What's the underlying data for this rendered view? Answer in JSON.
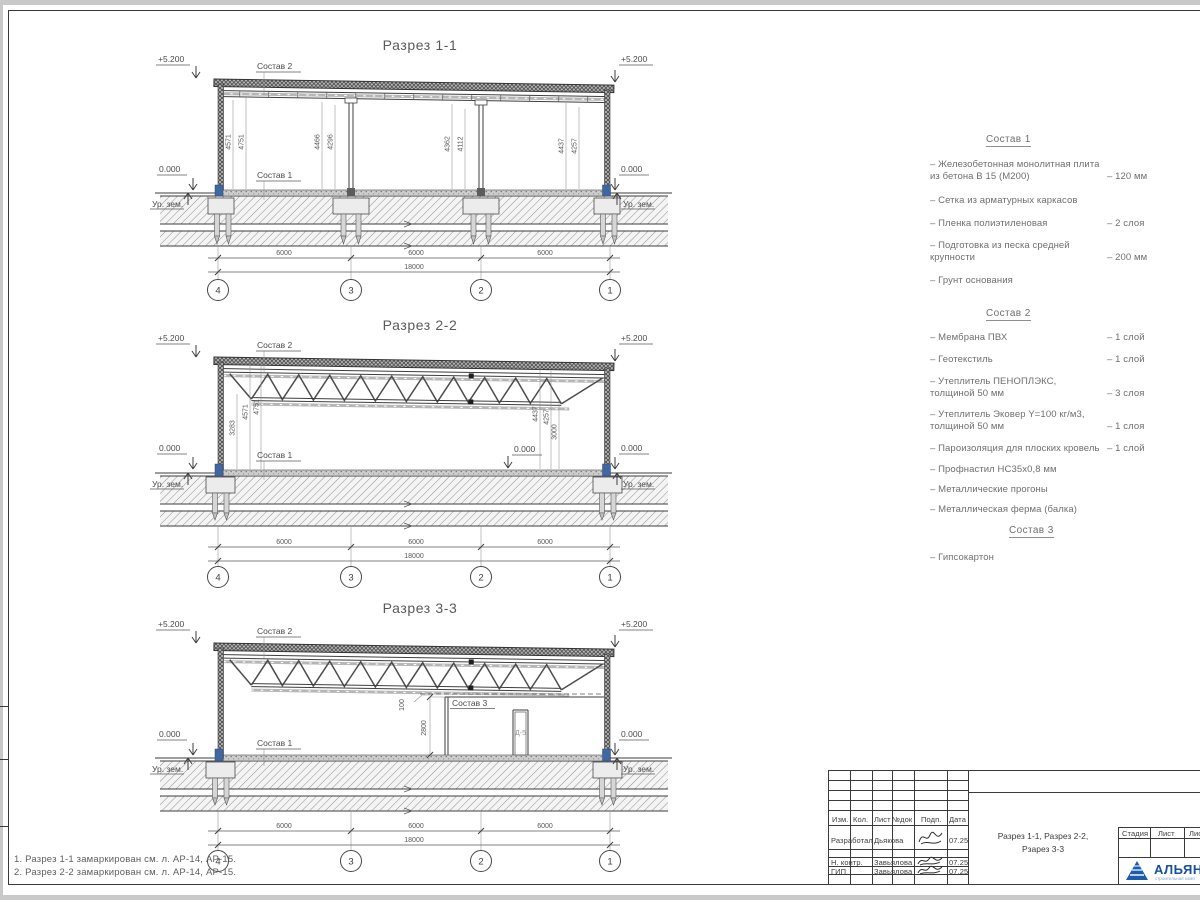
{
  "colors": {
    "logo_blue": "#17509e",
    "logo_sub_blue": "#7aa7d4",
    "line_dark": "#3a3a3a",
    "text_gray": "#6f6f6f",
    "column_base_blue": "#41679e"
  },
  "sections": {
    "s1": {
      "title": "Разрез 1-1",
      "elev": "+5.200",
      "zero": "0.000",
      "ground": "Ур. зем.",
      "c1": "Состав 1",
      "c2": "Состав 2",
      "v1": "4571",
      "v2": "4751",
      "v3": "4466",
      "v4": "4296",
      "v5": "4362",
      "v6": "4112",
      "v7": "4437",
      "v8": "4257",
      "d1": "6000",
      "d2": "6000",
      "d3": "6000",
      "dt": "18000",
      "a1": "4",
      "a2": "3",
      "a3": "2",
      "a4": "1"
    },
    "s2": {
      "title": "Разрез 2-2",
      "elev": "+5.200",
      "zero": "0.000",
      "ground": "Ур. зем.",
      "c1": "Состав 1",
      "c2": "Состав 2",
      "vl1": "3283",
      "vl2": "4571",
      "vl3": "4751",
      "vr1": "4437",
      "vr2": "4257",
      "vr3": "3000",
      "d1": "6000",
      "d2": "6000",
      "d3": "6000",
      "dt": "18000",
      "a1": "4",
      "a2": "3",
      "a3": "2",
      "a4": "1"
    },
    "s3": {
      "title": "Разрез 3-3",
      "elev": "+5.200",
      "zero": "0.000",
      "ground": "Ур. зем.",
      "c1": "Состав 1",
      "c2": "Состав 2",
      "c3": "Состав 3",
      "door": "Д-5",
      "g100": "100",
      "g2800": "2800",
      "d1": "6000",
      "d2": "6000",
      "d3": "6000",
      "dt": "18000",
      "a1": "4",
      "a2": "3",
      "a3": "2",
      "a4": "1"
    }
  },
  "materials": {
    "m1": {
      "h": "Состав 1",
      "i1a": "– Железобетонная  монолитная плита",
      "i1b": "из бетона В 15 (М200)",
      "i1v": "– 120 мм",
      "i2a": "– Сетка из арматурных каркасов",
      "i3a": "– Пленка полиэтиленовая",
      "i3v": "– 2 слоя",
      "i4a": "– Подготовка из песка средней",
      "i4b": "крупности",
      "i4v": "– 200 мм",
      "i5a": "– Грунт основания"
    },
    "m2": {
      "h": "Состав 2",
      "i1a": "– Мембрана ПВХ",
      "i1v": "– 1 слой",
      "i2a": "– Геотекстиль",
      "i2v": "– 1 слой",
      "i3a": "– Утеплитель ПЕНОПЛЭКС,",
      "i3b": "толщиной 50 мм",
      "i3v": "– 3 слоя",
      "i4a": "– Утеплитель Эковер Y=100 кг/м3,",
      "i4b": "толщиной 50 мм",
      "i4v": "– 1 слоя",
      "i5a": "– Пароизоляция для плоских кровель",
      "i5v": "– 1 слой",
      "i6a": "– Профнастил НС35х0,8 мм",
      "i7a": "– Металлические прогоны",
      "i8a": "– Металлическая ферма (балка)"
    },
    "m3": {
      "h": "Состав 3",
      "i1a": "– Гипсокартон"
    }
  },
  "notes": {
    "n1": "1. Разрез 1-1 замаркирован см. л. АР-14, АР-15.",
    "n2": "2. Разрез 2-2 замаркирован см. л. АР-14, АР-15."
  },
  "titleblock": {
    "h1": "Изм.",
    "h2": "Кол.",
    "h3": "Лист",
    "h4": "№док",
    "h5": "Подп.",
    "h6": "Дата",
    "r1": "Разработал",
    "r1n": "Дьякова",
    "r1d": "07.25",
    "r2": "Н. контр.",
    "r2n": "Завьялова",
    "r2d": "07.25",
    "r3": "ГИП",
    "r3n": "Завьялова",
    "r3d": "07.25",
    "t1": "Разрез 1-1, Разрез 2-2,",
    "t2": "Рзарез 3-3",
    "s1": "Стадия",
    "s2": "Лист",
    "s3": "Лис",
    "logo": "АЛЬЯН",
    "logo_sub": "строительная комп"
  }
}
